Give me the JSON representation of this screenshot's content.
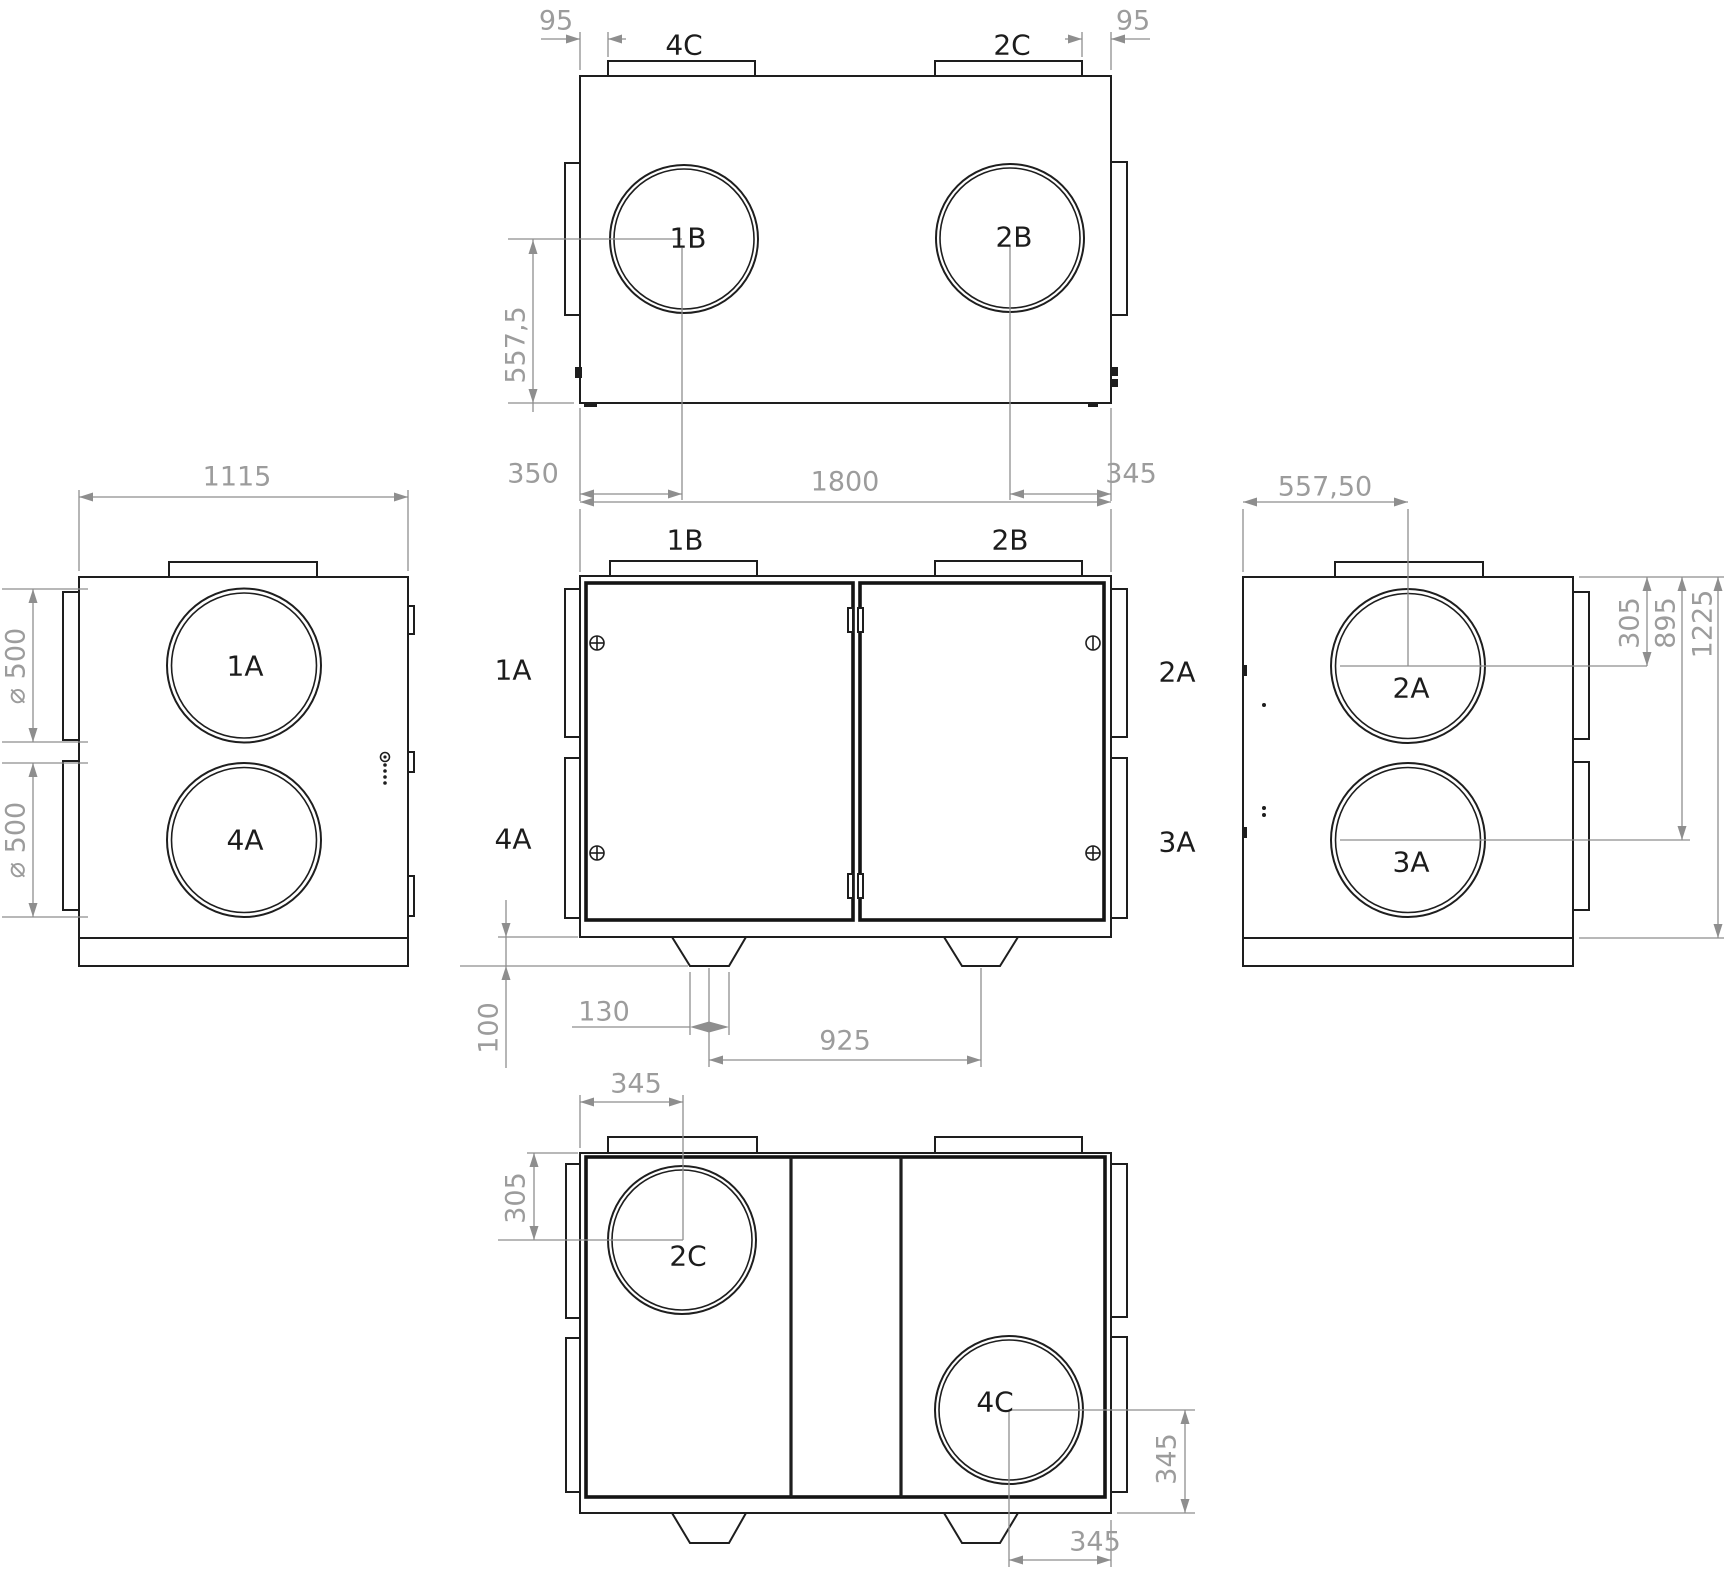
{
  "drawing": {
    "top_view": {
      "port_top_left": "4C",
      "port_top_right": "2C",
      "port_circle_left": "1B",
      "port_circle_right": "2B",
      "dim_offset_left": "95",
      "dim_offset_right": "95",
      "dim_depth_to_center": "557,5",
      "dim_left_to_center": "350",
      "dim_center_to_right": "345"
    },
    "left_view": {
      "dim_width": "1115",
      "port_circle_top": "1A",
      "port_circle_bottom": "4A",
      "dim_diameter_top": "⌀ 500",
      "dim_diameter_bottom": "⌀ 500"
    },
    "front_view": {
      "dim_width": "1800",
      "port_top_left": "1B",
      "port_top_right": "2B",
      "label_side_top_left": "1A",
      "label_side_bottom_left": "4A",
      "label_side_top_right": "2A",
      "label_side_bottom_right": "3A",
      "dim_foot_height": "100",
      "dim_foot_width": "130",
      "dim_feet_spacing": "925"
    },
    "right_view": {
      "dim_left_to_center": "557,50",
      "port_circle_top": "2A",
      "port_circle_bottom": "3A",
      "dim_top_to_upper_center": "305",
      "dim_top_to_lower_center": "895",
      "dim_total_height": "1225"
    },
    "bottom_view": {
      "dim_left_to_center": "345",
      "dim_top_to_center": "305",
      "port_circle_left": "2C",
      "port_circle_right": "4C",
      "dim_center_to_bottom": "345",
      "dim_center_to_right": "345"
    }
  }
}
